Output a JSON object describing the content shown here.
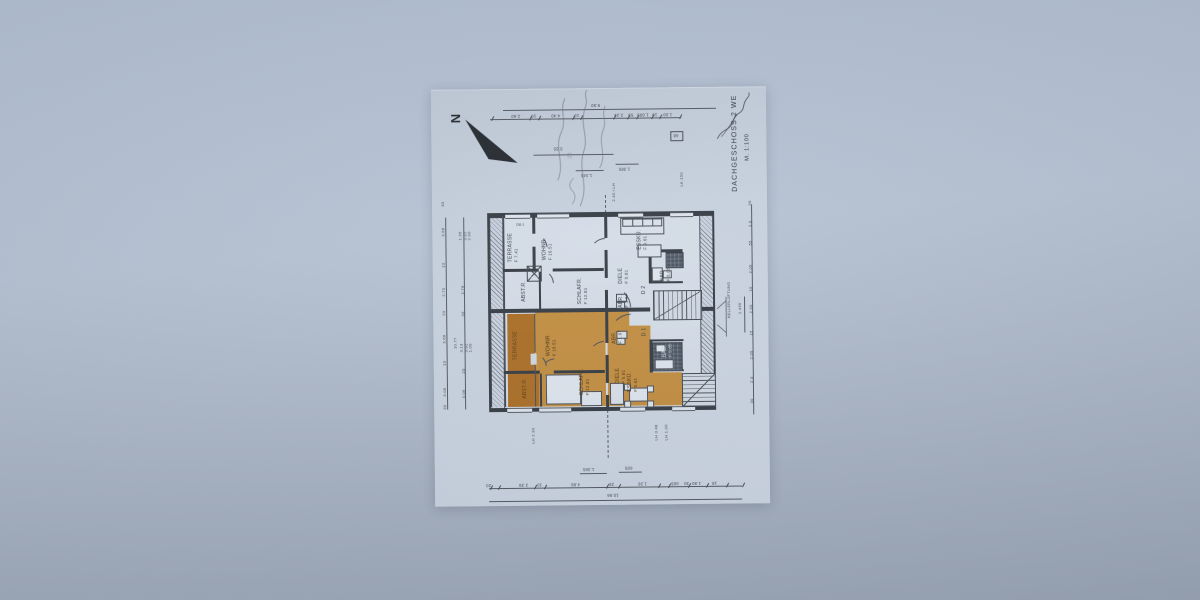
{
  "sheet": {
    "title": "DACHGESCHOSS  2 WE",
    "scale": "M. 1:100",
    "north_label": "N",
    "pencil_note": "23",
    "stamp": "DB 1"
  },
  "apartment_upper": {
    "terrasse": "TERRASSE",
    "terrasse_area": "F 7.41",
    "wohnraum": "WOHNR.",
    "wohnraum_area": "F 16.51",
    "abstellraum": "ABST.R.",
    "schlafraum": "SCHLAFR.",
    "schlafraum_area": "F 12.81",
    "diele": "DIELE",
    "diele_area": "F 5.81",
    "abort": "ABR.",
    "abort_area": "F 1.97",
    "esskueche": "ESSKÜ.",
    "esskueche_area": "F 9.61",
    "bad": "BAD",
    "bad_area": "F 5.05",
    "door": "D 2"
  },
  "apartment_lower": {
    "terrasse": "TERRASSE",
    "wohnraum": "WOHNR.",
    "wohnraum_area": "F 16.51",
    "abstellraum": "ABST.R.",
    "schlafraum": "SCHLAFR.",
    "schlafraum_area": "F 12.81",
    "diele": "DIELE",
    "diele_area": "F 5.81",
    "abort": "ABR.",
    "abort_area": "F 1.97",
    "esskueche": "ESSKÜ.",
    "esskueche_area": "F 9.61",
    "bad": "BAD",
    "bad_area": "F 5.05",
    "door": "D 1"
  },
  "annotations": {
    "keller": "KELLERLÜFTUNG",
    "lk": "LK 150",
    "ilh": "2.40 i.LH",
    "lh230": "LH 2.30",
    "lh348": "LH 3.48",
    "lh100": "LH 1.00"
  },
  "dims": {
    "top_total": "9.50",
    "top_row": [
      "2.60",
      "10",
      "4.40",
      "10",
      "2.26",
      "55",
      "1.685",
      "10",
      "1.00"
    ],
    "mid": "5.55",
    "box": "68",
    "b1345": "1.345",
    "b1385": "1.385",
    "b1365": "1.365",
    "b605": "605",
    "bottom_row": [
      "20",
      "2.39",
      "10",
      "4.86",
      "25",
      "1.26",
      "605",
      "30",
      "1.90",
      "18"
    ],
    "bottom_total": "10.96",
    "left_outer": [
      "30",
      "3.68",
      "10",
      "2.75",
      "20",
      "3.68",
      "10",
      "3.06",
      "30"
    ],
    "left_total": "10.77",
    "left_inner": [
      "1.35",
      "3.92",
      "2.90",
      "2.76",
      "30",
      "3.13",
      "3.92",
      "1.00",
      "20",
      "3.06"
    ],
    "right_col": [
      "30",
      "2.0",
      "55",
      "2.05",
      "15",
      "2.30",
      "15",
      "2.05",
      "2.0",
      "30"
    ],
    "right_bracket": "2.465"
  }
}
